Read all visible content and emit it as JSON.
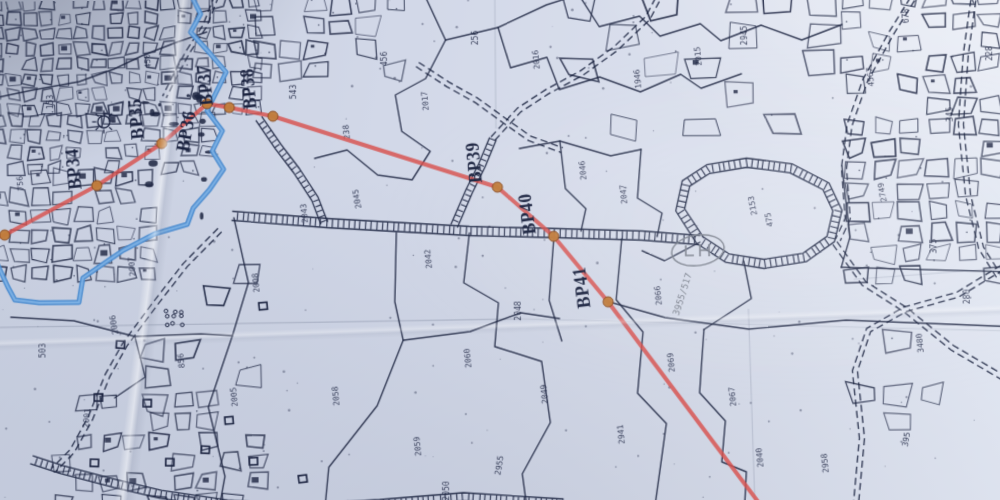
{
  "meta": {
    "description": "Photograph of a printed cadastral mouza map sheet with a red pipeline/boundary route, BP waypoint markers, blue river and hatched village roads",
    "script_note": "plot numbers on the sheet are Bengali numerals; values approximated with Latin digits"
  },
  "palette": {
    "ink": "#1b2340",
    "route_red": "#d8514d",
    "waypoint_fill": "#bf7c3a",
    "waypoint_edge": "#8a4a1f",
    "river_blue": "#4c8cd0",
    "river_core": "#7fb2e4",
    "grid": "#8e97ac",
    "pencil": "#7d838f",
    "paper_patch": "#d3d9e7"
  },
  "route": {
    "points": [
      [
        -6,
        236
      ],
      [
        12,
        231
      ],
      [
        103,
        183
      ],
      [
        167,
        142
      ],
      [
        212,
        103
      ],
      [
        234,
        107
      ],
      [
        277,
        116
      ],
      [
        498,
        188
      ],
      [
        553,
        237
      ],
      [
        606,
        302
      ],
      [
        756,
        506
      ]
    ],
    "waypoints": [
      [
        12,
        231
      ],
      [
        103,
        183
      ],
      [
        167,
        142
      ],
      [
        212,
        103
      ],
      [
        234,
        107
      ],
      [
        277,
        116
      ],
      [
        498,
        188
      ],
      [
        553,
        237
      ],
      [
        606,
        302
      ]
    ]
  },
  "bp_markers": [
    {
      "label": "BP34",
      "x": 86,
      "y": 166,
      "rot": -95
    },
    {
      "label": "BP35",
      "x": 148,
      "y": 117,
      "rot": -95
    },
    {
      "label": "BP36",
      "x": 197,
      "y": 131,
      "rot": -80
    },
    {
      "label": "BP37",
      "x": 216,
      "y": 84,
      "rot": -95
    },
    {
      "label": "BP38",
      "x": 259,
      "y": 88,
      "rot": -95
    },
    {
      "label": "BP39",
      "x": 481,
      "y": 163,
      "rot": -95
    },
    {
      "label": "BP40",
      "x": 533,
      "y": 214,
      "rot": -97
    },
    {
      "label": "BP41",
      "x": 586,
      "y": 287,
      "rot": -97
    }
  ],
  "river": {
    "points": [
      [
        197,
        -4
      ],
      [
        206,
        14
      ],
      [
        196,
        32
      ],
      [
        214,
        52
      ],
      [
        231,
        72
      ],
      [
        221,
        92
      ],
      [
        212,
        110
      ],
      [
        227,
        130
      ],
      [
        217,
        150
      ],
      [
        228,
        168
      ],
      [
        214,
        188
      ],
      [
        198,
        206
      ],
      [
        192,
        222
      ],
      [
        160,
        231
      ],
      [
        129,
        247
      ],
      [
        108,
        261
      ],
      [
        89,
        274
      ],
      [
        85,
        298
      ],
      [
        46,
        298
      ],
      [
        22,
        295
      ],
      [
        15,
        282
      ],
      [
        4,
        258
      ],
      [
        -2,
        248
      ]
    ]
  },
  "roads": [
    {
      "name": "main-east-road",
      "style": "hatched",
      "w": 9,
      "points": [
        [
          236,
          214
        ],
        [
          330,
          222
        ],
        [
          470,
          231
        ],
        [
          560,
          234
        ],
        [
          640,
          237
        ],
        [
          697,
          242
        ]
      ]
    },
    {
      "name": "bp38-spur-road",
      "style": "hatched",
      "w": 7,
      "points": [
        [
          263,
          118
        ],
        [
          282,
          146
        ],
        [
          300,
          170
        ],
        [
          318,
          198
        ],
        [
          327,
          222
        ]
      ]
    },
    {
      "name": "bp39-spur-road",
      "style": "hatched",
      "w": 7,
      "points": [
        [
          455,
          226
        ],
        [
          470,
          192
        ],
        [
          483,
          166
        ],
        [
          494,
          140
        ]
      ]
    },
    {
      "name": "bp39-track",
      "style": "dashed",
      "w": 5,
      "points": [
        [
          494,
          140
        ],
        [
          520,
          112
        ],
        [
          548,
          94
        ],
        [
          582,
          76
        ],
        [
          616,
          52
        ],
        [
          648,
          22
        ],
        [
          662,
          -4
        ]
      ]
    },
    {
      "name": "upper-track",
      "style": "dashed",
      "w": 5,
      "points": [
        [
          420,
          66
        ],
        [
          450,
          86
        ],
        [
          478,
          102
        ],
        [
          505,
          122
        ],
        [
          530,
          140
        ],
        [
          562,
          152
        ]
      ]
    },
    {
      "name": "bottom-road",
      "style": "hatched",
      "w": 8,
      "points": [
        [
          38,
          452
        ],
        [
          68,
          462
        ],
        [
          120,
          476
        ],
        [
          165,
          487
        ],
        [
          230,
          497
        ],
        [
          300,
          502
        ],
        [
          380,
          498
        ],
        [
          462,
          492
        ],
        [
          560,
          499
        ]
      ]
    },
    {
      "name": "left-track",
      "style": "dashed",
      "w": 5,
      "points": [
        [
          224,
          228
        ],
        [
          190,
          262
        ],
        [
          160,
          300
        ],
        [
          130,
          340
        ],
        [
          113,
          370
        ],
        [
          96,
          412
        ],
        [
          78,
          444
        ],
        [
          60,
          462
        ]
      ]
    },
    {
      "name": "market-loop-road",
      "style": "hatched",
      "w": 9,
      "closed": true,
      "points": [
        [
          697,
          242
        ],
        [
          678,
          212
        ],
        [
          684,
          186
        ],
        [
          706,
          172
        ],
        [
          744,
          166
        ],
        [
          788,
          172
        ],
        [
          822,
          190
        ],
        [
          833,
          214
        ],
        [
          826,
          242
        ],
        [
          800,
          260
        ],
        [
          760,
          266
        ],
        [
          724,
          260
        ],
        [
          697,
          242
        ]
      ]
    },
    {
      "name": "ne-diagonal-road",
      "style": "dashed",
      "w": 5,
      "points": [
        [
          916,
          -4
        ],
        [
          888,
          40
        ],
        [
          862,
          86
        ],
        [
          846,
          130
        ],
        [
          840,
          172
        ],
        [
          843,
          222
        ],
        [
          833,
          243
        ]
      ]
    },
    {
      "name": "east-edge-road",
      "style": "dashed",
      "w": 5,
      "points": [
        [
          972,
          -4
        ],
        [
          962,
          60
        ],
        [
          956,
          130
        ],
        [
          962,
          200
        ],
        [
          974,
          252
        ],
        [
          992,
          282
        ]
      ]
    },
    {
      "name": "se-junction-road-a",
      "style": "dashed",
      "w": 5,
      "points": [
        [
          830,
          246
        ],
        [
          858,
          286
        ],
        [
          898,
          312
        ],
        [
          944,
          350
        ],
        [
          1004,
          386
        ]
      ]
    },
    {
      "name": "se-junction-road-b",
      "style": "dashed",
      "w": 5,
      "points": [
        [
          1004,
          266
        ],
        [
          950,
          298
        ],
        [
          898,
          312
        ],
        [
          862,
          332
        ],
        [
          848,
          372
        ],
        [
          854,
          438
        ],
        [
          847,
          504
        ]
      ]
    },
    {
      "name": "tl-street",
      "style": "dashed",
      "w": 4,
      "points": [
        [
          222,
          -4
        ],
        [
          210,
          26
        ],
        [
          193,
          52
        ],
        [
          180,
          76
        ],
        [
          170,
          96
        ]
      ]
    }
  ],
  "parcel_boundaries": [
    [
      [
        238,
        216
      ],
      [
        252,
        280
      ],
      [
        236,
        332
      ],
      [
        212,
        402
      ],
      [
        228,
        470
      ],
      [
        222,
        502
      ]
    ],
    [
      [
        398,
        232
      ],
      [
        396,
        300
      ],
      [
        404,
        338
      ],
      [
        378,
        402
      ],
      [
        330,
        462
      ],
      [
        326,
        502
      ]
    ],
    [
      [
        470,
        233
      ],
      [
        464,
        282
      ],
      [
        498,
        302
      ],
      [
        494,
        345
      ],
      [
        540,
        360
      ],
      [
        548,
        420
      ],
      [
        520,
        470
      ],
      [
        524,
        502
      ]
    ],
    [
      [
        620,
        240
      ],
      [
        614,
        300
      ],
      [
        640,
        332
      ],
      [
        634,
        392
      ],
      [
        662,
        422
      ],
      [
        650,
        502
      ]
    ],
    [
      [
        428,
        -2
      ],
      [
        448,
        42
      ],
      [
        428,
        80
      ],
      [
        398,
        96
      ],
      [
        404,
        132
      ],
      [
        432,
        152
      ],
      [
        414,
        180
      ],
      [
        380,
        175
      ],
      [
        350,
        150
      ],
      [
        318,
        158
      ]
    ],
    [
      [
        448,
        42
      ],
      [
        500,
        30
      ],
      [
        548,
        8
      ],
      [
        580,
        -2
      ]
    ],
    [
      [
        500,
        30
      ],
      [
        512,
        70
      ],
      [
        548,
        60
      ],
      [
        560,
        92
      ],
      [
        600,
        80
      ],
      [
        640,
        95
      ],
      [
        680,
        78
      ],
      [
        700,
        92
      ],
      [
        740,
        78
      ]
    ],
    [
      [
        580,
        -2
      ],
      [
        600,
        30
      ],
      [
        640,
        20
      ],
      [
        660,
        40
      ],
      [
        700,
        28
      ],
      [
        720,
        45
      ],
      [
        760,
        30
      ],
      [
        800,
        45
      ],
      [
        840,
        30
      ]
    ],
    [
      [
        520,
        150
      ],
      [
        560,
        143
      ],
      [
        610,
        158
      ],
      [
        640,
        152
      ]
    ],
    [
      [
        560,
        143
      ],
      [
        565,
        190
      ],
      [
        585,
        210
      ],
      [
        580,
        232
      ]
    ],
    [
      [
        640,
        152
      ],
      [
        636,
        200
      ],
      [
        660,
        215
      ],
      [
        655,
        238
      ]
    ],
    [
      [
        640,
        252
      ],
      [
        662,
        262
      ],
      [
        697,
        244
      ]
    ],
    [
      [
        740,
        263
      ],
      [
        747,
        300
      ],
      [
        700,
        330
      ]
    ],
    [
      [
        607,
        302
      ],
      [
        662,
        318
      ],
      [
        744,
        330
      ],
      [
        840,
        322
      ],
      [
        1004,
        330
      ]
    ],
    [
      [
        836,
        270
      ],
      [
        1004,
        276
      ]
    ],
    [
      [
        700,
        330
      ],
      [
        695,
        392
      ],
      [
        720,
        420
      ],
      [
        716,
        460
      ],
      [
        740,
        470
      ],
      [
        738,
        502
      ]
    ],
    [
      [
        838,
        170
      ],
      [
        845,
        240
      ],
      [
        836,
        270
      ]
    ],
    [
      [
        404,
        338
      ],
      [
        470,
        330
      ],
      [
        520,
        312
      ],
      [
        558,
        318
      ]
    ],
    [
      [
        18,
        312
      ],
      [
        80,
        316
      ],
      [
        140,
        332
      ],
      [
        205,
        330
      ],
      [
        236,
        332
      ]
    ],
    [
      [
        140,
        332
      ],
      [
        150,
        372
      ],
      [
        120,
        392
      ]
    ],
    [
      [
        553,
        240
      ],
      [
        548,
        300
      ],
      [
        560,
        340
      ]
    ],
    [
      [
        0,
        96
      ],
      [
        40,
        88
      ],
      [
        86,
        80
      ],
      [
        120,
        68
      ],
      [
        150,
        54
      ],
      [
        182,
        42
      ],
      [
        212,
        32
      ]
    ]
  ],
  "grid_lines": [
    {
      "x1": 0,
      "y1": 322,
      "x2": 520,
      "y2": 318,
      "op": 0.75
    },
    {
      "x1": 520,
      "y1": 318,
      "x2": 1000,
      "y2": 334,
      "op": 0.35
    },
    {
      "x1": 497,
      "y1": 2,
      "x2": 497,
      "y2": 130,
      "op": 0.5
    },
    {
      "x1": 744,
      "y1": 310,
      "x2": 748,
      "y2": 500,
      "op": 0.5
    },
    {
      "x1": 848,
      "y1": 282,
      "x2": 1000,
      "y2": 272,
      "op": 0.4
    }
  ],
  "symbols": {
    "sun": {
      "x": 110,
      "y": 120,
      "r": 6
    },
    "ellipse_landmark": {
      "cx": 695,
      "cy": 252,
      "rx": 26,
      "ry": 15,
      "rot": -8
    },
    "orchard": {
      "x": 170,
      "y": 306
    },
    "buildings": [
      [
        122,
        336
      ],
      [
        100,
        388
      ],
      [
        148,
        394
      ],
      [
        205,
        440
      ],
      [
        228,
        412
      ],
      [
        252,
        452
      ],
      [
        300,
        470
      ],
      [
        96,
        452
      ],
      [
        262,
        300
      ],
      [
        170,
        452
      ]
    ]
  },
  "parcel_labels": [
    {
      "t": "2007",
      "x": 140,
      "y": 263,
      "r": -95
    },
    {
      "t": "2006",
      "x": 122,
      "y": 320,
      "r": -100
    },
    {
      "t": "503",
      "x": 52,
      "y": 345,
      "r": -90
    },
    {
      "t": "2001",
      "x": 95,
      "y": 412,
      "r": -85
    },
    {
      "t": "2005",
      "x": 240,
      "y": 392,
      "r": -95
    },
    {
      "t": "2043",
      "x": 310,
      "y": 212,
      "r": -95
    },
    {
      "t": "2045",
      "x": 362,
      "y": 198,
      "r": -100
    },
    {
      "t": "2042",
      "x": 432,
      "y": 258,
      "r": -95
    },
    {
      "t": "2060",
      "x": 470,
      "y": 356,
      "r": -95
    },
    {
      "t": "2048",
      "x": 520,
      "y": 310,
      "r": -90
    },
    {
      "t": "2049",
      "x": 545,
      "y": 392,
      "r": -95
    },
    {
      "t": "2955",
      "x": 500,
      "y": 462,
      "r": -80
    },
    {
      "t": "2046",
      "x": 585,
      "y": 172,
      "r": -95
    },
    {
      "t": "2047",
      "x": 625,
      "y": 196,
      "r": -95
    },
    {
      "t": "2069",
      "x": 670,
      "y": 362,
      "r": -95
    },
    {
      "t": "2067",
      "x": 730,
      "y": 396,
      "r": -95
    },
    {
      "t": "2040",
      "x": 756,
      "y": 456,
      "r": -95
    },
    {
      "t": "2958",
      "x": 820,
      "y": 462,
      "r": -95
    },
    {
      "t": "395",
      "x": 900,
      "y": 440,
      "r": -80
    },
    {
      "t": "3480",
      "x": 915,
      "y": 345,
      "r": -95
    },
    {
      "t": "2749",
      "x": 880,
      "y": 196,
      "r": -100
    },
    {
      "t": "375",
      "x": 930,
      "y": 250,
      "r": -90
    },
    {
      "t": "280",
      "x": 962,
      "y": 300,
      "r": -90
    },
    {
      "t": "2015",
      "x": 700,
      "y": 60,
      "r": -95
    },
    {
      "t": "2945",
      "x": 746,
      "y": 40,
      "r": -90
    },
    {
      "t": "1946",
      "x": 640,
      "y": 82,
      "r": -95
    },
    {
      "t": "2016",
      "x": 540,
      "y": 62,
      "r": -95
    },
    {
      "t": "256",
      "x": 480,
      "y": 40,
      "r": -90
    },
    {
      "t": "2017",
      "x": 430,
      "y": 102,
      "r": -95
    },
    {
      "t": "456",
      "x": 390,
      "y": 60,
      "r": -90
    },
    {
      "t": "238",
      "x": 352,
      "y": 132,
      "r": -95
    },
    {
      "t": "543",
      "x": 300,
      "y": 92,
      "r": -90
    },
    {
      "t": "450",
      "x": 156,
      "y": 60,
      "r": -95
    },
    {
      "t": "153",
      "x": 60,
      "y": 100,
      "r": -90
    },
    {
      "t": "756",
      "x": 30,
      "y": 180,
      "r": -95
    },
    {
      "t": "2008",
      "x": 262,
      "y": 280,
      "r": -95
    },
    {
      "t": "2153",
      "x": 752,
      "y": 208,
      "r": -100
    },
    {
      "t": "475",
      "x": 768,
      "y": 222,
      "r": -100
    },
    {
      "t": "4567",
      "x": 870,
      "y": 82,
      "r": -95
    },
    {
      "t": "345",
      "x": 948,
      "y": 120,
      "r": -90
    },
    {
      "t": "228",
      "x": 988,
      "y": 60,
      "r": -90
    },
    {
      "t": "678",
      "x": 906,
      "y": 22,
      "r": -90
    },
    {
      "t": "2941",
      "x": 620,
      "y": 432,
      "r": -95
    },
    {
      "t": "2059",
      "x": 420,
      "y": 442,
      "r": -95
    },
    {
      "t": "2058",
      "x": 340,
      "y": 392,
      "r": -95
    },
    {
      "t": "2066",
      "x": 658,
      "y": 296,
      "r": -95
    },
    {
      "t": "2050",
      "x": 448,
      "y": 486,
      "r": -90
    },
    {
      "t": "856",
      "x": 188,
      "y": 356,
      "r": -95
    }
  ],
  "pencil_label": {
    "t": "3955/517",
    "x": 682,
    "y": 296,
    "r": -72
  }
}
